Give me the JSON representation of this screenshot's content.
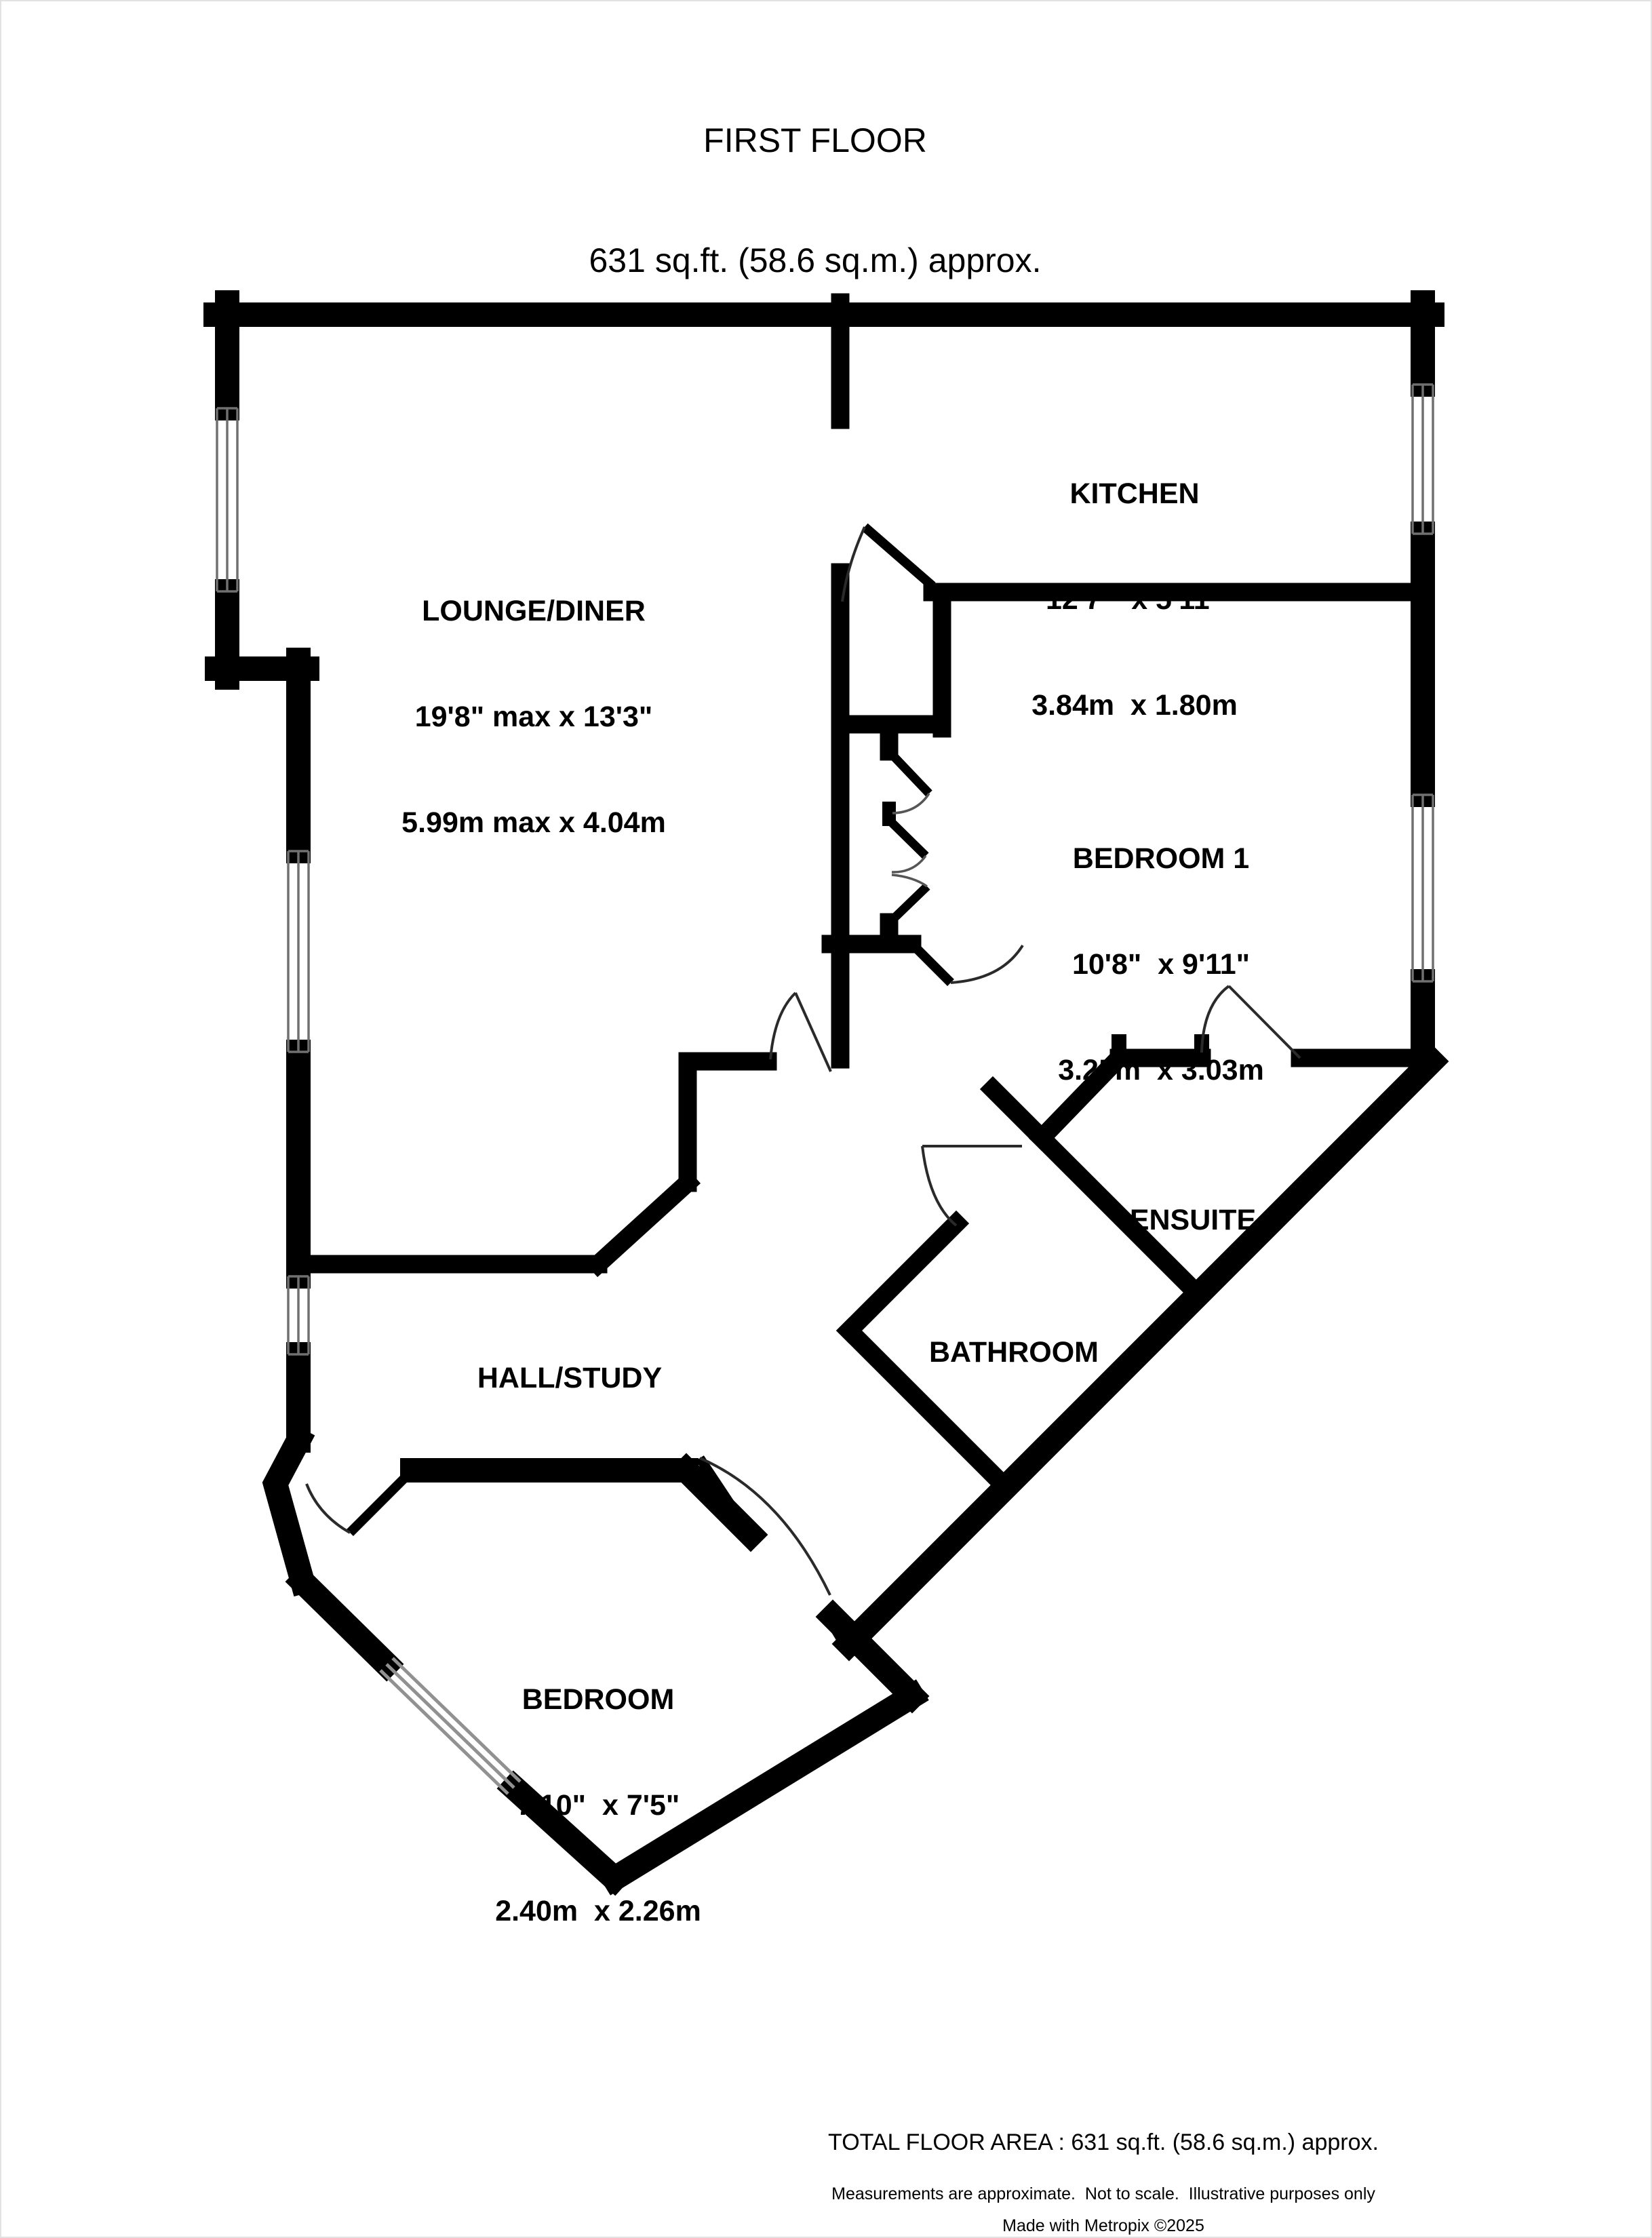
{
  "header": {
    "title": "FIRST FLOOR",
    "subtitle": "631 sq.ft. (58.6 sq.m.) approx."
  },
  "rooms": {
    "lounge": {
      "name": "LOUNGE/DINER",
      "imperial": "19'8\" max x 13'3\"",
      "metric": "5.99m max x 4.04m"
    },
    "kitchen": {
      "name": "KITCHEN",
      "imperial": "12'7\"  x 5'11\"",
      "metric": "3.84m  x 1.80m"
    },
    "bedroom1": {
      "name": "BEDROOM 1",
      "imperial": "10'8\"  x 9'11\"",
      "metric": "3.25m  x 3.03m"
    },
    "ensuite": {
      "name": "ENSUITE"
    },
    "bathroom": {
      "name": "BATHROOM"
    },
    "hall": {
      "name": "HALL/STUDY"
    },
    "bedroom2": {
      "name": "BEDROOM",
      "imperial": "7'10\"  x 7'5\"",
      "metric": "2.40m  x 2.26m"
    }
  },
  "footer": {
    "total": "TOTAL FLOOR AREA : 631 sq.ft. (58.6 sq.m.) approx.",
    "disclaimer": "Measurements are approximate.  Not to scale.  Illustrative purposes only",
    "credit": "Made with Metropix ©2025"
  },
  "colors": {
    "wall": "#000000",
    "door_line": "#2a2a2a",
    "window_line": "#707070",
    "bedroom_window_line": "#919191",
    "background": "#ffffff",
    "text": "#000000"
  }
}
